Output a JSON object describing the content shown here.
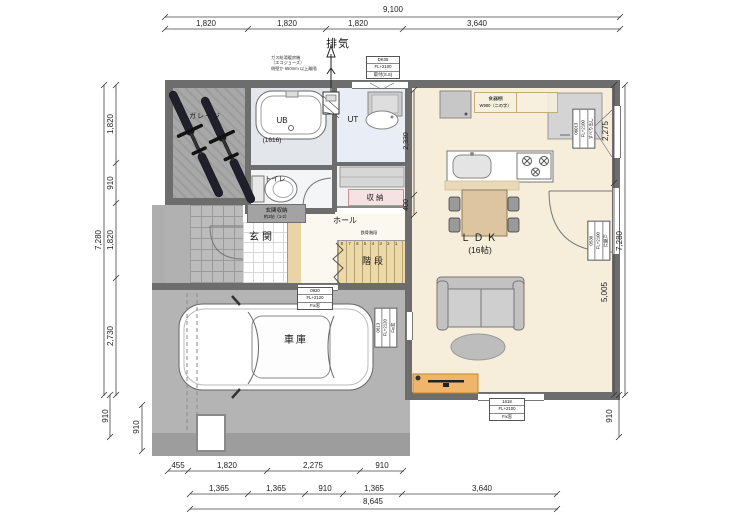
{
  "plan": {
    "rooms": {
      "bike_garage": "ガレージ",
      "bath": "UB",
      "bath_size": "(1616)",
      "toilet": "トイレ",
      "utility": "UT",
      "closet": "収納",
      "hall": "ホール",
      "entrance": "玄関",
      "entrance_storage_1": "玄関収納",
      "entrance_storage_2": "約2帖（1-2）",
      "stairs": "階段",
      "stairs_note": "鉄骨階段",
      "stair_numbers": "8 7 6 5 4 3 2 1",
      "ldk": "ＬＤＫ",
      "ldk_size": "(16帖)",
      "car_garage": "車庫",
      "dish_shelf_1": "食器棚",
      "dish_shelf_2": "W900（二の字）"
    },
    "exhaust": "排気",
    "gas_note_1": "ガス給湯暖房機",
    "gas_note_2": "（エコジョーズ）",
    "gas_note_3": "側壁か 650mm 以上離隔",
    "tags": {
      "ut_top": [
        "DK05",
        "FL+2100",
        "取付(S.S)"
      ],
      "stairs_fix": [
        "0920",
        "FL+2120",
        "Fix窓"
      ],
      "kitchen_side": [
        "06013",
        "FL+2100",
        "すべり出し"
      ],
      "living_door": [
        "0530",
        "FL+2100",
        "片開戸"
      ],
      "ldk_fix": [
        "1618",
        "FL+2100",
        "Fix窓"
      ],
      "garage_fix": [
        "0613",
        "FL+2120",
        "Fix窓"
      ]
    }
  },
  "dims": {
    "top": {
      "total": "9,100",
      "seg": [
        "1,820",
        "1,820",
        "1,820",
        "3,640"
      ]
    },
    "left": {
      "total": "7,280",
      "seg": [
        "1,820",
        "910",
        "1,820",
        "2,730"
      ],
      "bottom": "910",
      "inner": "910"
    },
    "right": {
      "upper": "2,275",
      "lower": "5,005",
      "total": "7,280",
      "bottom": "910"
    },
    "inner": {
      "a": "2,330",
      "b": "400"
    },
    "bottom": {
      "row1": [
        "455",
        "1,820",
        "2,275",
        "910"
      ],
      "row2": [
        "1,365",
        "1,365",
        "910",
        "1,365",
        "3,640"
      ],
      "total": "8,645"
    }
  },
  "colors": {
    "wall": "#6d6d6d",
    "ldk_floor": "#f6eeda",
    "garage_floor": "#b4b4b4",
    "utility_floor": "#e9eef6",
    "stairs": "#edd9a8",
    "table": "#dcc5a0",
    "tv_board": "#f0b46a",
    "closet_label_bg": "#f6e2e2"
  }
}
